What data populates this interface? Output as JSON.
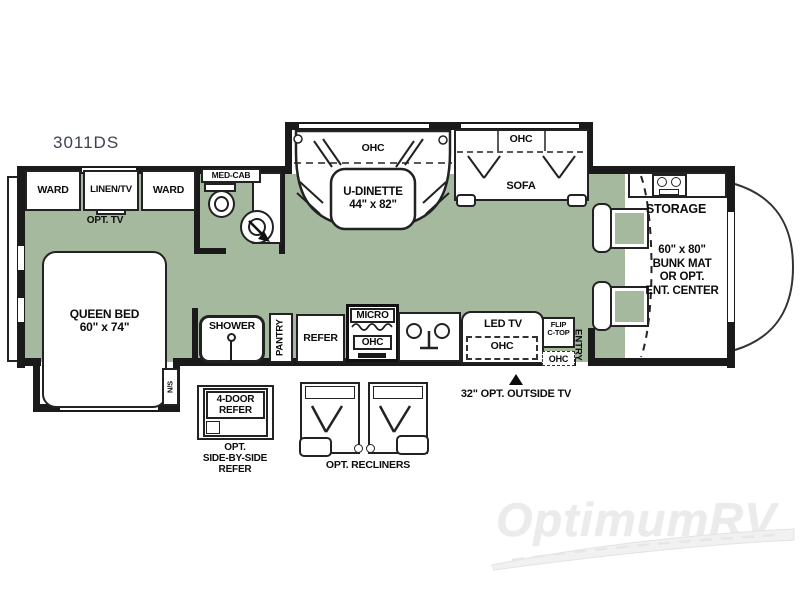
{
  "model": "3011DS",
  "watermark": "OptimumRV",
  "colors": {
    "floor": "#a5b99e",
    "wall": "#1a1a1a",
    "furniture": "#ffffff",
    "model_text": "#3c4250",
    "watermark_text": "#ebebeb"
  },
  "rooms": {
    "bedroom": {
      "ward_left": "WARD",
      "linen_tv": "LINEN/TV",
      "ward_right": "WARD",
      "opt_tv": "OPT. TV",
      "queen_bed": "QUEEN BED\n60\" x 74\"",
      "nightstand": "N/S"
    },
    "bath": {
      "med_cab": "MED-CAB",
      "shower": "SHOWER"
    },
    "galley": {
      "pantry": "PANTRY",
      "refer": "REFER",
      "micro": "MICRO",
      "micro_ohc": "OHC"
    },
    "living": {
      "dinette_ohc": "OHC",
      "dinette": "U-DINETTE\n44\" x 82\"",
      "sofa_ohc": "OHC",
      "sofa": "SOFA",
      "led_tv": "LED TV",
      "led_tv_ohc": "OHC",
      "flip_ctop": "FLIP\nC-TOP",
      "entry": "ENTRY",
      "entry_ohc": "OHC"
    },
    "front": {
      "storage": "STORAGE",
      "bunk": "60\" x 80\"\nBUNK MAT\nOR OPT.\nENT. CENTER"
    }
  },
  "options": {
    "outside_tv": "32\" OPT. OUTSIDE TV",
    "refer_box": "4-DOOR\nREFER",
    "refer_caption": "OPT.\nSIDE-BY-SIDE\nREFER",
    "recliners": "OPT. RECLINERS"
  }
}
